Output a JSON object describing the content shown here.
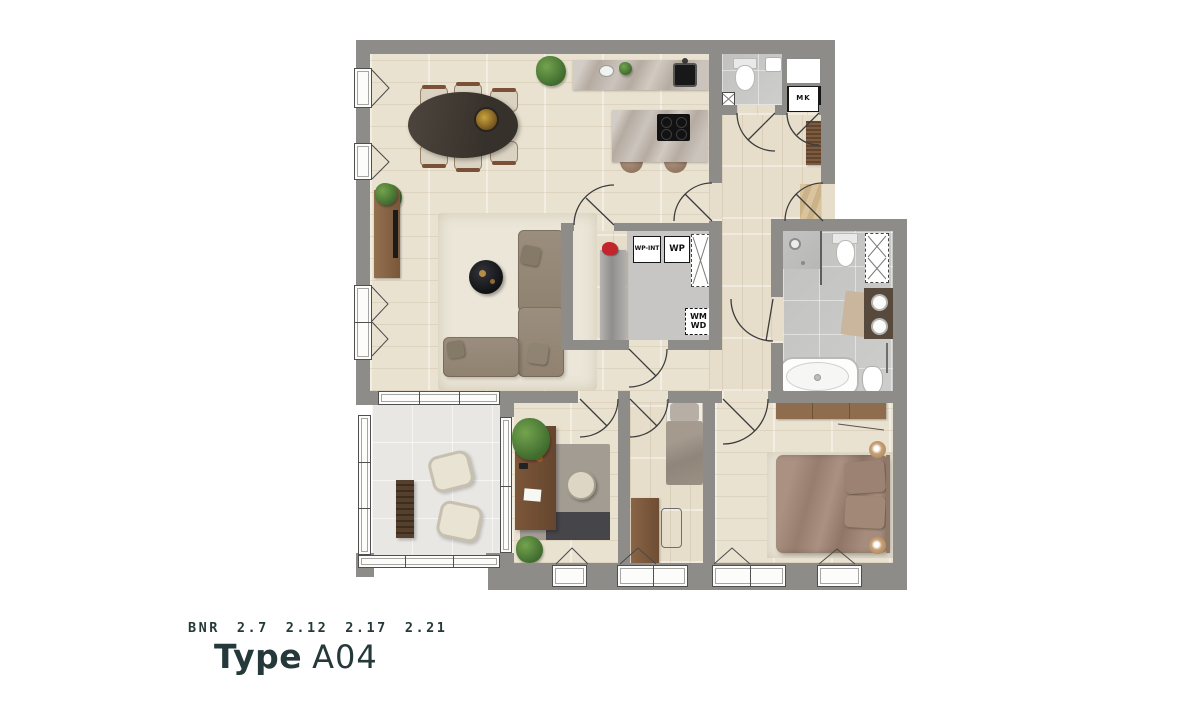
{
  "caption": {
    "bnr_label": "BNR",
    "bnr_numbers": [
      "2.7",
      "2.12",
      "2.17",
      "2.21"
    ],
    "type_label": "Type",
    "type_value": "A04"
  },
  "plan_labels": {
    "mk": "MK",
    "wp_int": "WP-INT",
    "wp": "WP",
    "wm": "WM",
    "wd": "WD"
  },
  "colors": {
    "wall": "#8d8c89",
    "ink": "#25393a",
    "wood": "#eae2d1",
    "wood2": "#e6ddcb",
    "bath-tile": "#cbcbc9",
    "balcony-tile": "#e8e7e4",
    "storage-floor": "#c7c6c4",
    "marble": "#b5aba1",
    "sofa": "#97897a",
    "bed": "#a68c7c",
    "rug": "#ebe6d8",
    "furn-wood": "#7d5b3e",
    "plant": "#4c7a36",
    "red": "#c2262c"
  }
}
